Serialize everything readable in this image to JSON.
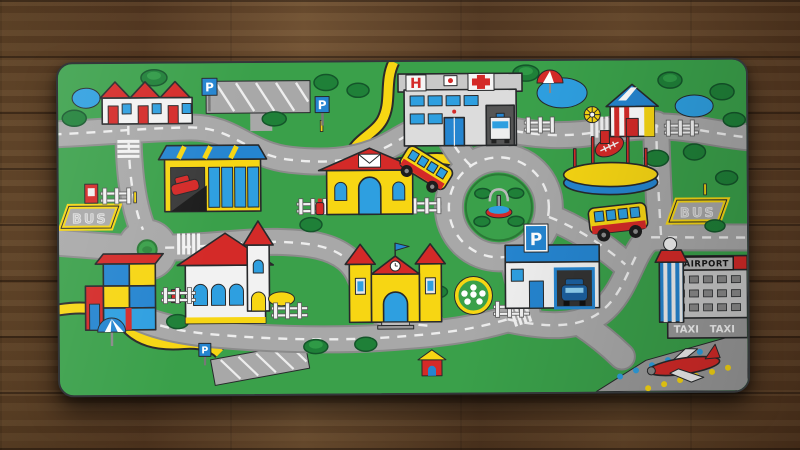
{
  "scene": {
    "description": "Photo-style view of a children's city-roads play mat lying on a brown wooden plank floor",
    "floor": {
      "material": "wood-planks",
      "color": "#6b4827"
    },
    "mat": {
      "labels": {
        "bus_left": "BUS",
        "bus_right": "BUS",
        "hospital_h": "H",
        "airport": "AIRPORT",
        "taxi_1": "TAXI",
        "taxi_2": "TAXI",
        "p_lot": "P",
        "p_median": "P",
        "p_garage": "P",
        "p_south": "P"
      },
      "colors": {
        "grass": "#3aa04a",
        "road": "#a8a8a8",
        "road_edge": "#8b8b8b",
        "marking": "#ededed",
        "accent_yellow": "#f7d613",
        "accent_red": "#d42a28",
        "accent_blue": "#2585d0",
        "water_blue": "#2e9fe0",
        "outline": "#27292b"
      },
      "features": [
        "row-houses",
        "parking-lot",
        "car-dealership",
        "post-office",
        "hospital",
        "ambulance",
        "school-bus",
        "fountain-roundabout",
        "small-roundabout",
        "stadium",
        "city-bus",
        "beach-house",
        "ponds",
        "beach-umbrellas",
        "pinwheel",
        "church",
        "toy-block-shop",
        "castle-school",
        "flower-bed",
        "parking-garage",
        "airport-terminal",
        "control-tower",
        "airplane",
        "runway",
        "bus-bays",
        "dog-house",
        "fences",
        "trees",
        "postboxes",
        "fire-hydrant"
      ]
    }
  }
}
